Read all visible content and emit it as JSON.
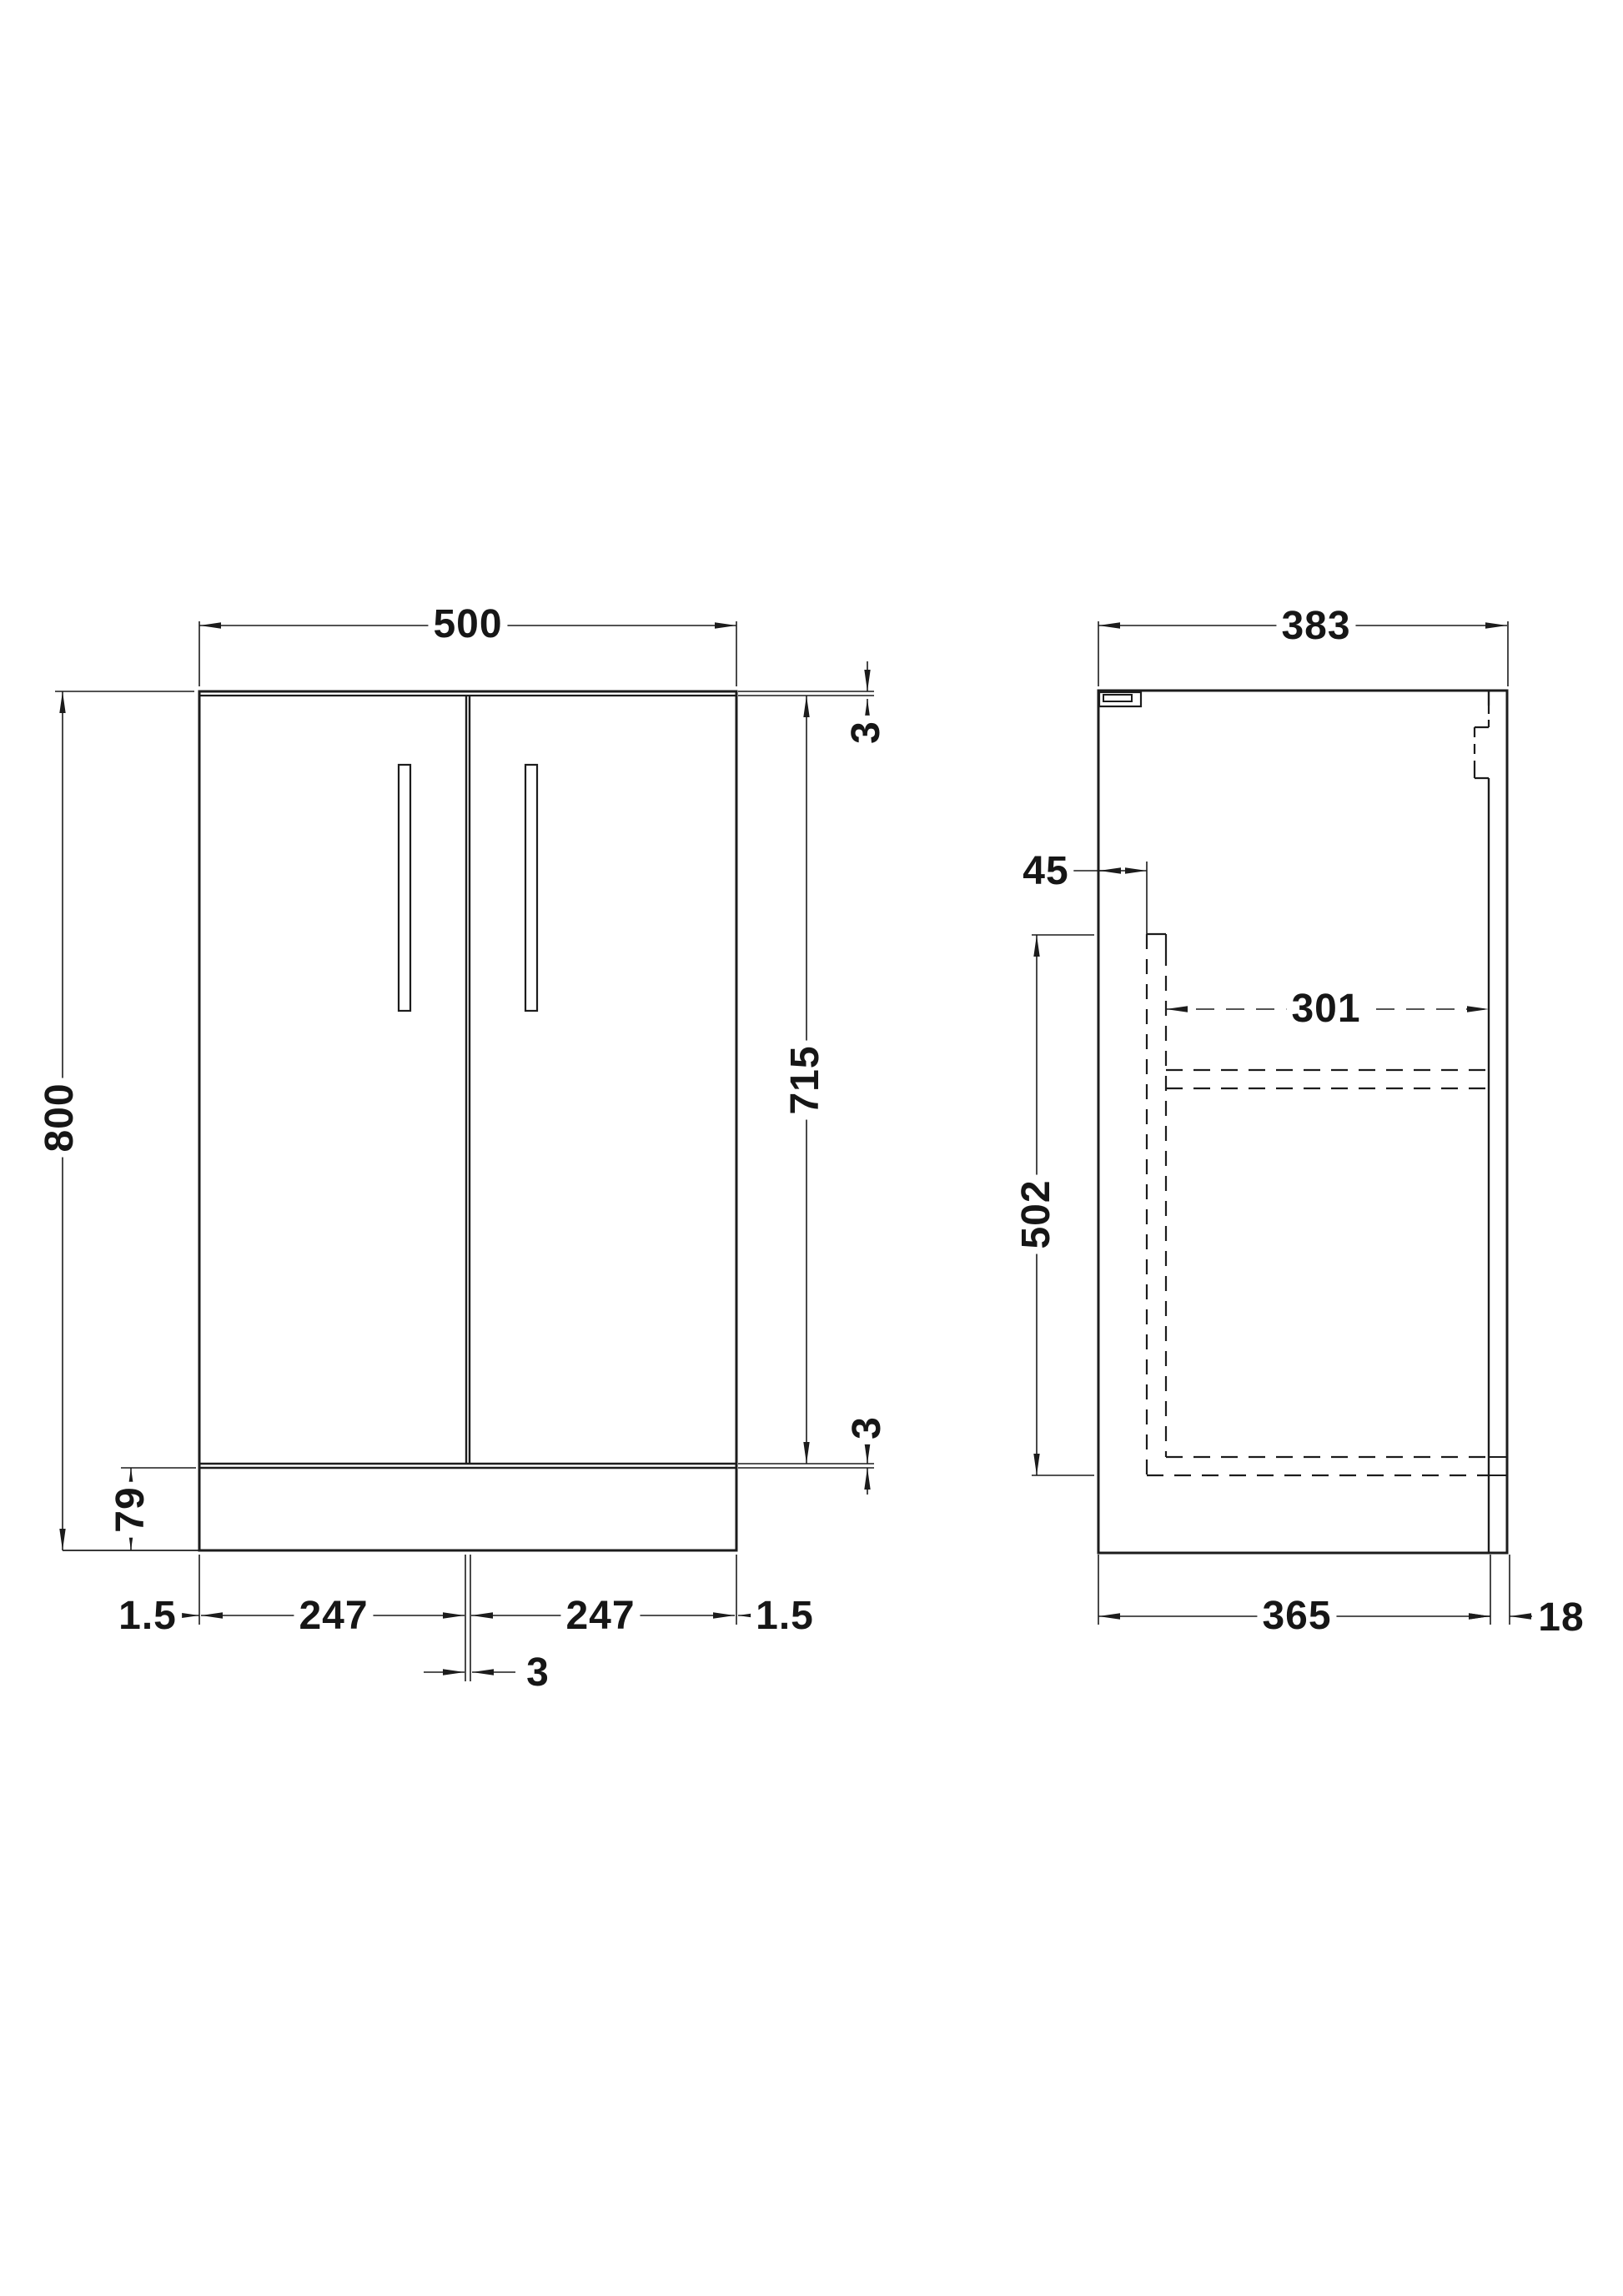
{
  "drawing_colors": {
    "background": "#ffffff",
    "line_ink": "#1c1c1c"
  },
  "front_view": {
    "width": "500",
    "height": "800",
    "door_height": "715",
    "top_gap": "3",
    "bottom_gap": "3",
    "plinth_height": "79",
    "left_edge_gap": "1.5",
    "left_door_width": "247",
    "right_door_width": "247",
    "right_edge_gap": "1.5",
    "center_door_gap": "3"
  },
  "side_view": {
    "overall_depth": "383",
    "front_panel_inset": "45",
    "internal_depth": "301",
    "internal_height": "502",
    "carcass_depth": "365",
    "back_rail_thickness": "18"
  }
}
